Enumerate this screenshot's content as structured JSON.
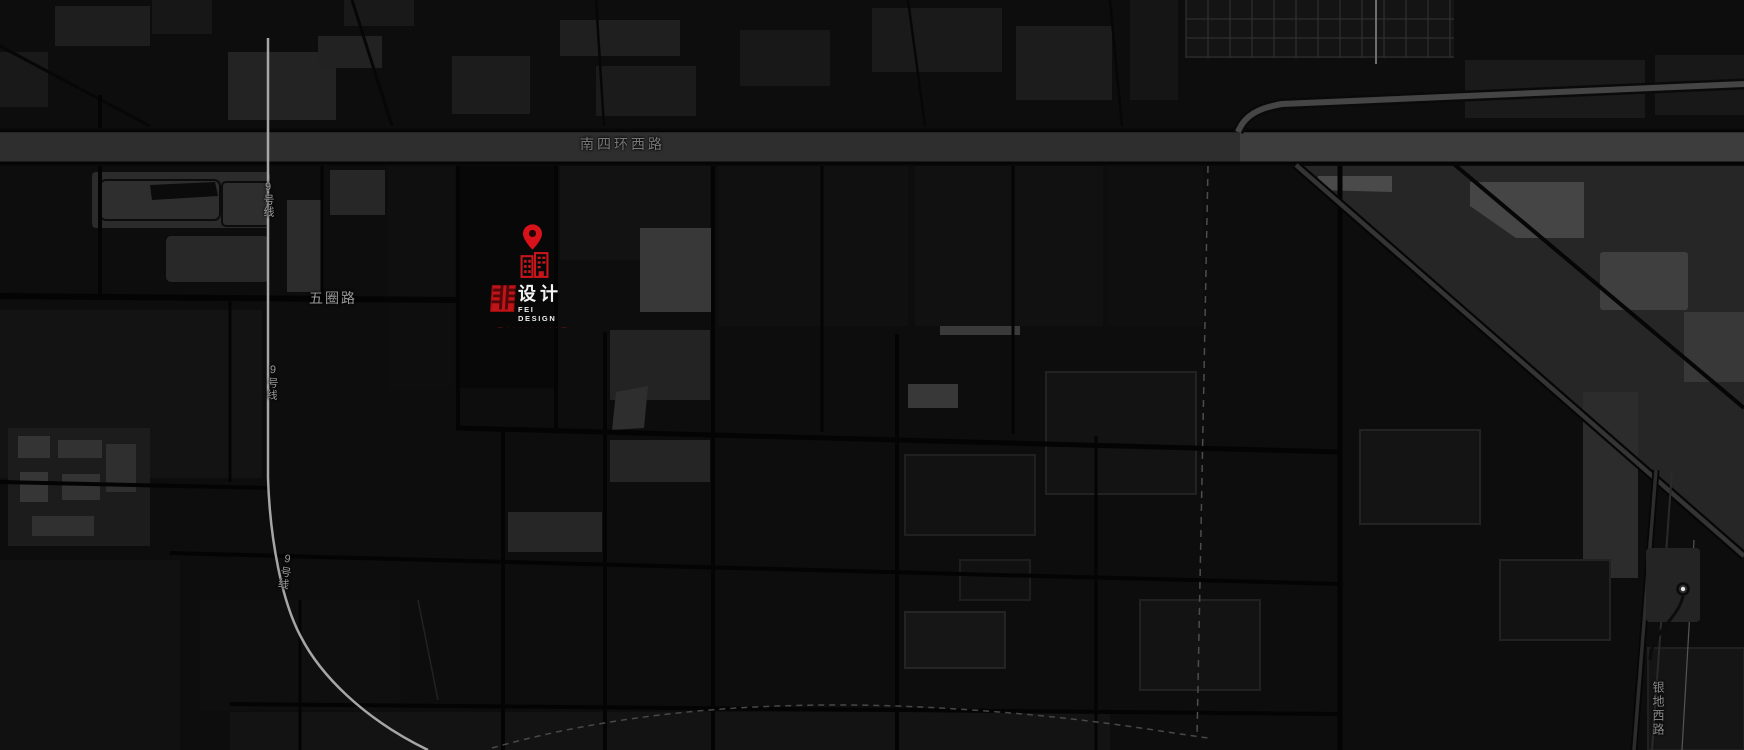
{
  "colors": {
    "background": "#0d0d0d",
    "accent_red": "#d8121a",
    "logo_red": "#bf1418",
    "highway_fill": "#2e2e2e",
    "metro_line_gray": "#a6a6a6",
    "road_label_gray": "#787878"
  },
  "roads": {
    "south_fourth_ring_west": "南四环西路",
    "wuquan_road": "五圈路",
    "yindi_west_road": "银地西路"
  },
  "metro": {
    "line9_label": "9号线"
  },
  "marker": {
    "pin_icon": "map-pin",
    "building_icon": "office-building"
  },
  "logo": {
    "seal_char": "非",
    "brand_cn": "设计",
    "brand_en": "FEI DESIGN",
    "tagline": "— · · · · · · · · · —"
  }
}
